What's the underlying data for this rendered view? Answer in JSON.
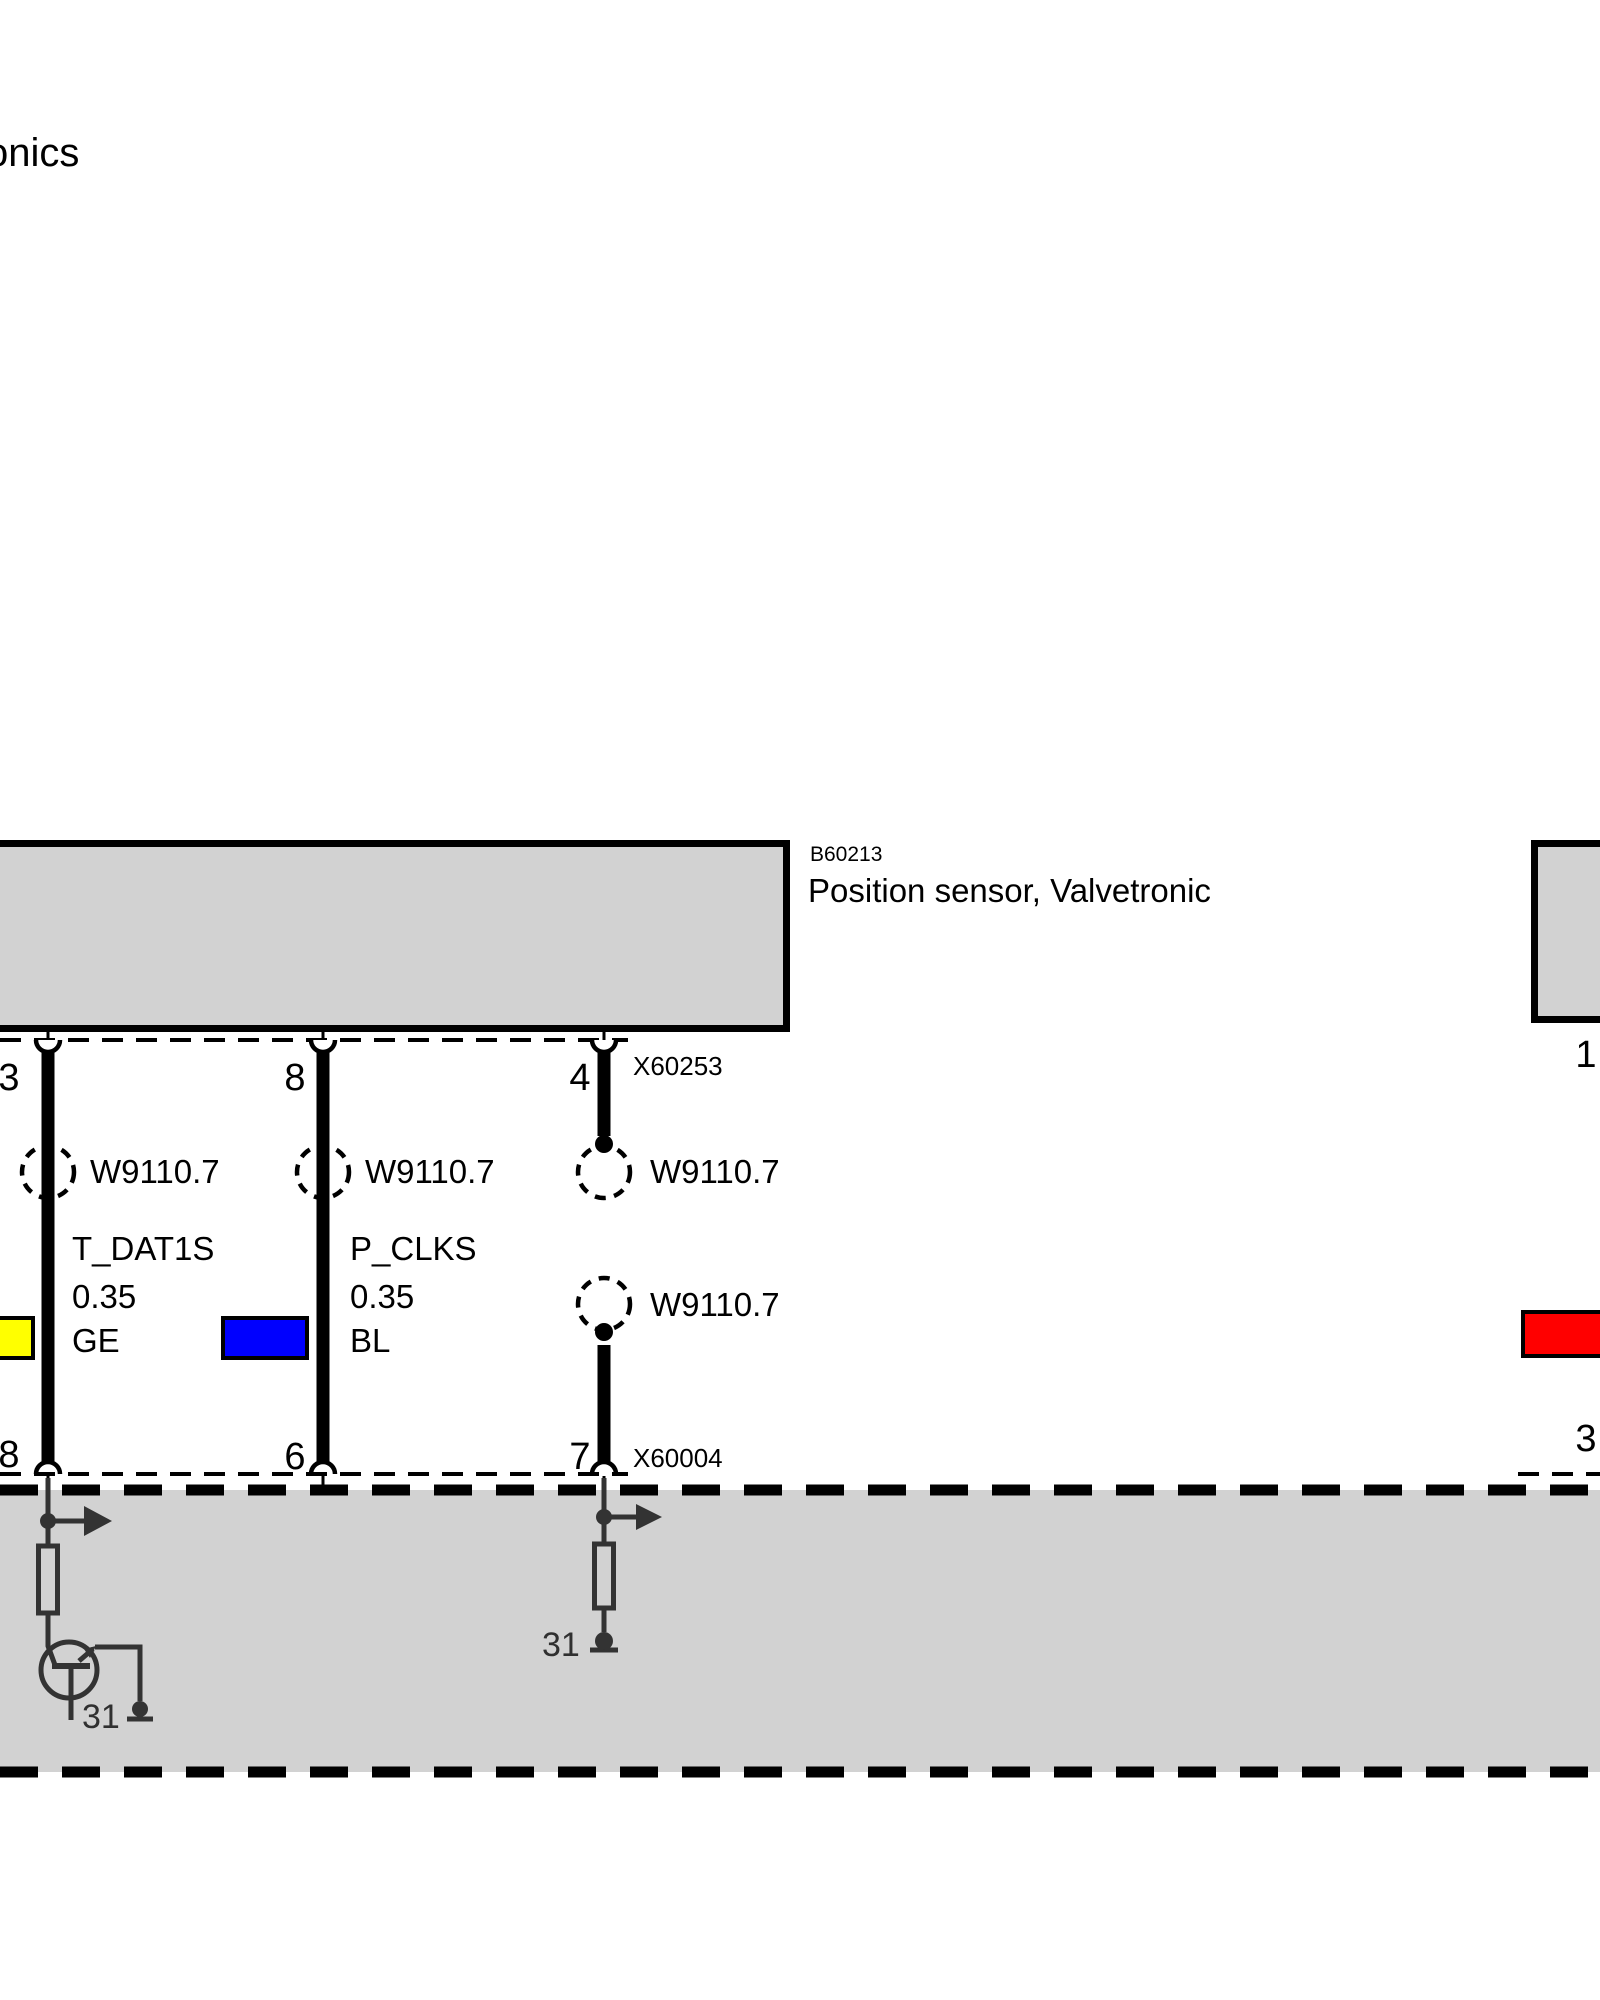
{
  "header": {
    "title_partial": "onics"
  },
  "component": {
    "code": "B60213",
    "label": "Position sensor, Valvetronic"
  },
  "connectors": {
    "top": {
      "code": "X60253",
      "pin_left": "3",
      "pin_mid": "8",
      "pin_right": "4"
    },
    "bottom": {
      "code": "X60004",
      "pin_left": "8",
      "pin_mid": "6",
      "pin_right": "7"
    },
    "right_component": {
      "pin_top": "1",
      "pin_bottom": "3"
    }
  },
  "wires": {
    "t_dat1s": {
      "signal": "T_DAT1S",
      "cross_section": "0.35",
      "color_code": "GE",
      "color_hex": "#FFFF00"
    },
    "p_clks": {
      "signal": "P_CLKS",
      "cross_section": "0.35",
      "color_code": "BL",
      "color_hex": "#0000FF"
    },
    "right_wire": {
      "color_hex": "#FF0000"
    }
  },
  "twisted_pair": {
    "label": "W9110.7"
  },
  "ground": {
    "terminal": "31"
  },
  "colors": {
    "box_fill": "#D2D2D2",
    "line": "#000000",
    "ecu_line": "#333333"
  }
}
